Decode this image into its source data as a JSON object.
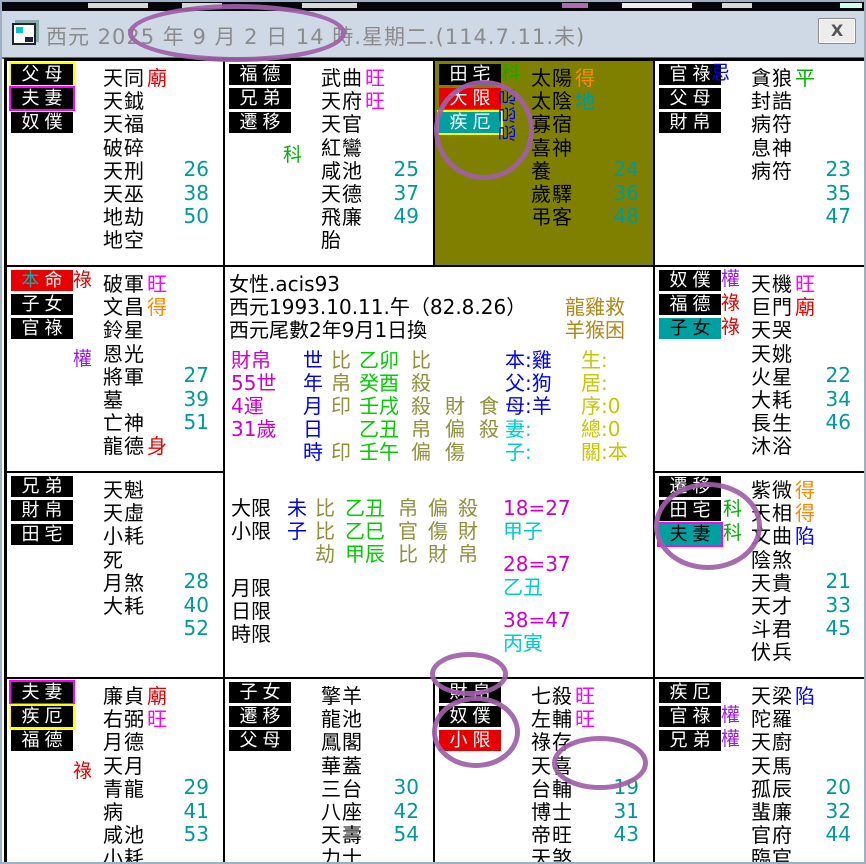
{
  "window": {
    "title": "西元 2025 年 9 月 2 日 14 時.星期二.(114.7.11.未)",
    "close_label": "X"
  },
  "colors": {
    "annotation": "#a05fa8",
    "olive_cell_bg": "#808000",
    "value_teal": "#009999",
    "bright_red": "#e60000",
    "bright_magenta": "#ff00ff",
    "bright_orange": "#ff8800",
    "bright_green": "#00b300",
    "bright_blue": "#0000f0",
    "purple_quan": "#9b19e6"
  },
  "palaces": {
    "p1": {
      "labels": [
        {
          "t": "父母",
          "c": "bk wt yb"
        },
        {
          "t": "夫妻",
          "c": "bk wt mb"
        },
        {
          "t": "奴僕",
          "c": "bk wt"
        }
      ],
      "trans": [],
      "stars": [
        [
          "天同",
          "廟",
          "r",
          ""
        ],
        [
          "天鉞",
          "",
          "",
          ""
        ],
        [
          "天福",
          "",
          "",
          ""
        ],
        [
          "破碎",
          "",
          "",
          ""
        ],
        [
          "天刑",
          "",
          "",
          "26"
        ],
        [
          "天巫",
          "",
          "",
          "38"
        ],
        [
          "地劫",
          "",
          "",
          "50"
        ],
        [
          "地空",
          "",
          "",
          ""
        ]
      ]
    },
    "p2": {
      "labels": [
        {
          "t": "福德",
          "c": "bk wt"
        },
        {
          "t": "兄弟",
          "c": "bk wt"
        },
        {
          "t": "遷移",
          "c": "bk wt"
        }
      ],
      "trans": [
        [
          "科",
          "g",
          58,
          84
        ]
      ],
      "stars": [
        [
          "武曲",
          "旺",
          "m",
          ""
        ],
        [
          "天府",
          "旺",
          "m",
          ""
        ],
        [
          "天官",
          "",
          "",
          ""
        ],
        [
          "紅鸞",
          "",
          "",
          ""
        ],
        [
          "咸池",
          "",
          "",
          "25"
        ],
        [
          "天德",
          "",
          "",
          "37"
        ],
        [
          "飛廉",
          "",
          "",
          "49"
        ],
        [
          "胎",
          "",
          "",
          ""
        ]
      ]
    },
    "p3": {
      "olive": true,
      "labels": [
        {
          "t": "田宅",
          "c": "bk wt"
        },
        {
          "t": "大限",
          "c": "br wt"
        },
        {
          "t": "疾厄",
          "c": "bt wt yb"
        }
      ],
      "trans": [
        [
          "科",
          "g",
          66,
          2
        ]
      ],
      "rot": {
        "chars": "忌忌忌",
        "color": "b",
        "x": 64,
        "y": 26
      },
      "stars": [
        [
          "太陽",
          "得",
          "o",
          ""
        ],
        [
          "太陰",
          "地",
          "t",
          ""
        ],
        [
          "寡宿",
          "",
          "",
          ""
        ],
        [
          "喜神",
          "",
          "",
          ""
        ],
        [
          "養",
          "",
          "",
          "24"
        ],
        [
          "歲驛",
          "",
          "",
          "36"
        ],
        [
          "弔客",
          "",
          "",
          "48"
        ]
      ]
    },
    "p4": {
      "labels": [
        {
          "t": "官祿",
          "c": "bk wt"
        },
        {
          "t": "父母",
          "c": "bk wt"
        },
        {
          "t": "財帛",
          "c": "bk wt"
        }
      ],
      "trans": [
        [
          "忌",
          "b",
          56,
          2
        ]
      ],
      "stars": [
        [
          "貪狼",
          "平",
          "g",
          ""
        ],
        [
          "封誥",
          "",
          "",
          ""
        ],
        [
          "病符",
          "",
          "",
          ""
        ],
        [
          "息神",
          "",
          "",
          ""
        ],
        [
          "病符",
          "",
          "",
          "23"
        ],
        [
          "",
          "",
          "",
          "35"
        ],
        [
          "",
          "",
          "",
          "47"
        ]
      ]
    },
    "p5": {
      "labels": [
        {
          "t": "本命",
          "c": "br",
          "chars": [
            [
              "本",
              "#00b3b3"
            ],
            [
              "命",
              "#ffffff"
            ]
          ]
        },
        {
          "t": "子女",
          "c": "bk wt"
        },
        {
          "t": "官祿",
          "c": "bk wt"
        }
      ],
      "trans": [
        [
          "祿",
          "r",
          66,
          3
        ],
        [
          "權",
          "p",
          66,
          82
        ]
      ],
      "stars": [
        [
          "破軍",
          "旺",
          "m",
          ""
        ],
        [
          "文昌",
          "得",
          "o",
          ""
        ],
        [
          "鈴星",
          "",
          "",
          ""
        ],
        [
          "恩光",
          "",
          "",
          ""
        ],
        [
          "將軍",
          "",
          "",
          "27"
        ],
        [
          "墓",
          "",
          "",
          "39"
        ],
        [
          "亡神",
          "",
          "",
          "51"
        ],
        [
          "龍德",
          "身",
          "r",
          ""
        ]
      ]
    },
    "p6": {
      "labels": [
        {
          "t": "奴僕",
          "c": "bk wt"
        },
        {
          "t": "福德",
          "c": "bk wt"
        },
        {
          "t": "子女",
          "c": "bt kt"
        }
      ],
      "trans": [
        [
          "權",
          "p",
          66,
          2
        ],
        [
          "祿",
          "r",
          66,
          26
        ],
        [
          "祿",
          "r",
          66,
          50
        ]
      ],
      "stars": [
        [
          "天機",
          "旺",
          "m",
          ""
        ],
        [
          "巨門",
          "廟",
          "r",
          ""
        ],
        [
          "天哭",
          "",
          "",
          ""
        ],
        [
          "天姚",
          "",
          "",
          ""
        ],
        [
          "火星",
          "",
          "",
          "22"
        ],
        [
          "大耗",
          "",
          "",
          "34"
        ],
        [
          "長生",
          "",
          "",
          "46"
        ],
        [
          "沐浴",
          "",
          "",
          ""
        ]
      ]
    },
    "p7": {
      "labels": [
        {
          "t": "兄弟",
          "c": "bk wt"
        },
        {
          "t": "財帛",
          "c": "bk wt"
        },
        {
          "t": "田宅",
          "c": "bk wt"
        }
      ],
      "trans": [],
      "stars": [
        [
          "天魁",
          "",
          "",
          ""
        ],
        [
          "天虛",
          "",
          "",
          ""
        ],
        [
          "小耗",
          "",
          "",
          ""
        ],
        [
          "死",
          "",
          "",
          ""
        ],
        [
          "月煞",
          "",
          "",
          "28"
        ],
        [
          "大耗",
          "",
          "",
          "40"
        ],
        [
          "",
          "",
          "",
          "52"
        ]
      ]
    },
    "p9": {
      "labels": [
        {
          "t": "遷移",
          "c": "bk wt"
        },
        {
          "t": "田宅",
          "c": "bk wt"
        },
        {
          "t": "夫妻",
          "c": "bt kt mb"
        }
      ],
      "trans": [
        [
          "科",
          "g",
          68,
          26
        ],
        [
          "科",
          "g",
          68,
          50
        ]
      ],
      "stars": [
        [
          "紫微",
          "得",
          "o",
          ""
        ],
        [
          "天相",
          "得",
          "o",
          ""
        ],
        [
          "文曲",
          "陷",
          "b",
          ""
        ],
        [
          "陰煞",
          "",
          "",
          ""
        ],
        [
          "天貴",
          "",
          "",
          "21"
        ],
        [
          "天才",
          "",
          "",
          "33"
        ],
        [
          "斗君",
          "",
          "",
          "45"
        ],
        [
          "伏兵",
          "",
          "",
          ""
        ]
      ]
    },
    "p10": {
      "labels": [
        {
          "t": "夫妻",
          "c": "bk wt mb"
        },
        {
          "t": "疾厄",
          "c": "bk wt yb"
        },
        {
          "t": "福德",
          "c": "bk wt"
        }
      ],
      "trans": [
        [
          "祿",
          "r",
          66,
          82
        ]
      ],
      "stars": [
        [
          "廉貞",
          "廟",
          "r",
          ""
        ],
        [
          "右弼",
          "旺",
          "m",
          ""
        ],
        [
          "月德",
          "",
          "",
          ""
        ],
        [
          "天月",
          "",
          "",
          ""
        ],
        [
          "青龍",
          "",
          "",
          "29"
        ],
        [
          "病",
          "",
          "",
          "41"
        ],
        [
          "咸池",
          "",
          "",
          "53"
        ],
        [
          "小耗",
          "",
          "",
          ""
        ]
      ]
    },
    "p11": {
      "labels": [
        {
          "t": "子女",
          "c": "bk wt"
        },
        {
          "t": "遷移",
          "c": "bk wt"
        },
        {
          "t": "父母",
          "c": "bk wt"
        }
      ],
      "trans": [],
      "stars": [
        [
          "擎羊",
          "",
          "",
          ""
        ],
        [
          "龍池",
          "",
          "",
          ""
        ],
        [
          "鳳閣",
          "",
          "",
          ""
        ],
        [
          "華蓋",
          "",
          "",
          ""
        ],
        [
          "三台",
          "",
          "",
          "30"
        ],
        [
          "八座",
          "",
          "",
          "42"
        ],
        [
          "天壽",
          "",
          "",
          "54"
        ],
        [
          "力士",
          "",
          "",
          ""
        ]
      ]
    },
    "p12": {
      "labels": [
        {
          "t": "財帛",
          "c": "bk wt"
        },
        {
          "t": "奴僕",
          "c": "bk wt"
        },
        {
          "t": "小限",
          "c": "br wt"
        }
      ],
      "trans": [],
      "stars": [
        [
          "七殺",
          "旺",
          "m",
          ""
        ],
        [
          "左輔",
          "旺",
          "m",
          ""
        ],
        [
          "祿存",
          "",
          "",
          ""
        ],
        [
          "天喜",
          "",
          "",
          ""
        ],
        [
          "台輔",
          "",
          "",
          "19"
        ],
        [
          "博士",
          "",
          "",
          "31"
        ],
        [
          "帝旺",
          "",
          "",
          "43"
        ],
        [
          "天煞",
          "",
          "",
          ""
        ]
      ]
    },
    "p13": {
      "labels": [
        {
          "t": "疾厄",
          "c": "bk wt"
        },
        {
          "t": "官祿",
          "c": "bk wt"
        },
        {
          "t": "兄弟",
          "c": "bk wt"
        }
      ],
      "trans": [
        [
          "權",
          "p",
          66,
          26
        ],
        [
          "權",
          "p",
          66,
          50
        ]
      ],
      "stars": [
        [
          "天梁",
          "陷",
          "b",
          ""
        ],
        [
          "陀羅",
          "",
          "",
          ""
        ],
        [
          "天廚",
          "",
          "",
          ""
        ],
        [
          "天馬",
          "",
          "",
          ""
        ],
        [
          "孤辰",
          "",
          "",
          "20"
        ],
        [
          "蜚廉",
          "",
          "",
          "32"
        ],
        [
          "官府",
          "",
          "",
          "44"
        ],
        [
          "臨官",
          "",
          "",
          ""
        ]
      ]
    }
  },
  "center": {
    "profile": [
      "女性.acis93",
      "西元1993.10.11.午（82.8.26）",
      "西元尾數2年9月1日換"
    ],
    "profile_right": [
      "龍雞救",
      "羊猴困"
    ],
    "bazi_rows": [
      {
        "a": "財帛",
        "b": "世",
        "c": "比",
        "d": "乙卯",
        "e": [
          "比",
          "",
          ""
        ],
        "f": "本:雞",
        "fc": "bl",
        "g": "生:"
      },
      {
        "a": "55世",
        "b": "年",
        "c": "帛",
        "d": "癸酉",
        "e": [
          "殺",
          "",
          ""
        ],
        "f": "父:狗",
        "fc": "bl",
        "g": "居:"
      },
      {
        "a": "4運",
        "b": "月",
        "c": "印",
        "d": "壬戌",
        "e": [
          "殺",
          "財",
          "食"
        ],
        "f": "母:羊",
        "fc": "bl",
        "g": "序:0"
      },
      {
        "a": "31歲",
        "b": "日",
        "c": "",
        "d": "乙丑",
        "e": [
          "帛",
          "偏",
          "殺"
        ],
        "f": "妻:",
        "fc": "cy",
        "g": "總:0"
      },
      {
        "a": "",
        "b": "時",
        "c": "印",
        "d": "壬午",
        "e": [
          "偏",
          "傷",
          ""
        ],
        "f": "子:",
        "fc": "cy",
        "g": "關:本"
      }
    ],
    "limit_rows": [
      {
        "a": "大限",
        "b": "未",
        "c": "比",
        "d": "乙丑",
        "e": [
          "帛",
          "偏",
          "殺"
        ]
      },
      {
        "a": "小限",
        "b": "子",
        "c": "比",
        "d": "乙巳",
        "e": [
          "官",
          "傷",
          "財"
        ]
      },
      {
        "a": "",
        "b": "",
        "c": "劫",
        "d": "甲辰",
        "e": [
          "比",
          "財",
          "帛"
        ]
      },
      {
        "a": "月限",
        "b": "",
        "c": "",
        "d": "",
        "e": []
      },
      {
        "a": "日限",
        "b": "",
        "c": "",
        "d": "",
        "e": []
      },
      {
        "a": "時限",
        "b": "",
        "c": "",
        "d": "",
        "e": []
      }
    ],
    "decades": [
      "18=27",
      "甲子",
      "28=37",
      "乙丑",
      "38=47",
      "丙寅"
    ]
  },
  "annotations": [
    {
      "note": "circle-title-date",
      "x": 126,
      "y": 2,
      "w": 218,
      "h": 58
    },
    {
      "note": "circle-daxian-jie-labels",
      "x": 432,
      "y": 78,
      "w": 100,
      "h": 100
    },
    {
      "note": "circle-tianzhai-fuqi-ke",
      "x": 652,
      "y": 480,
      "w": 108,
      "h": 88
    },
    {
      "note": "circle-caibo-label",
      "x": 428,
      "y": 650,
      "w": 78,
      "h": 44
    },
    {
      "note": "circle-xiaoxian-label",
      "x": 430,
      "y": 694,
      "w": 88,
      "h": 72
    },
    {
      "note": "circle-tianxi-star",
      "x": 550,
      "y": 734,
      "w": 96,
      "h": 54
    }
  ]
}
